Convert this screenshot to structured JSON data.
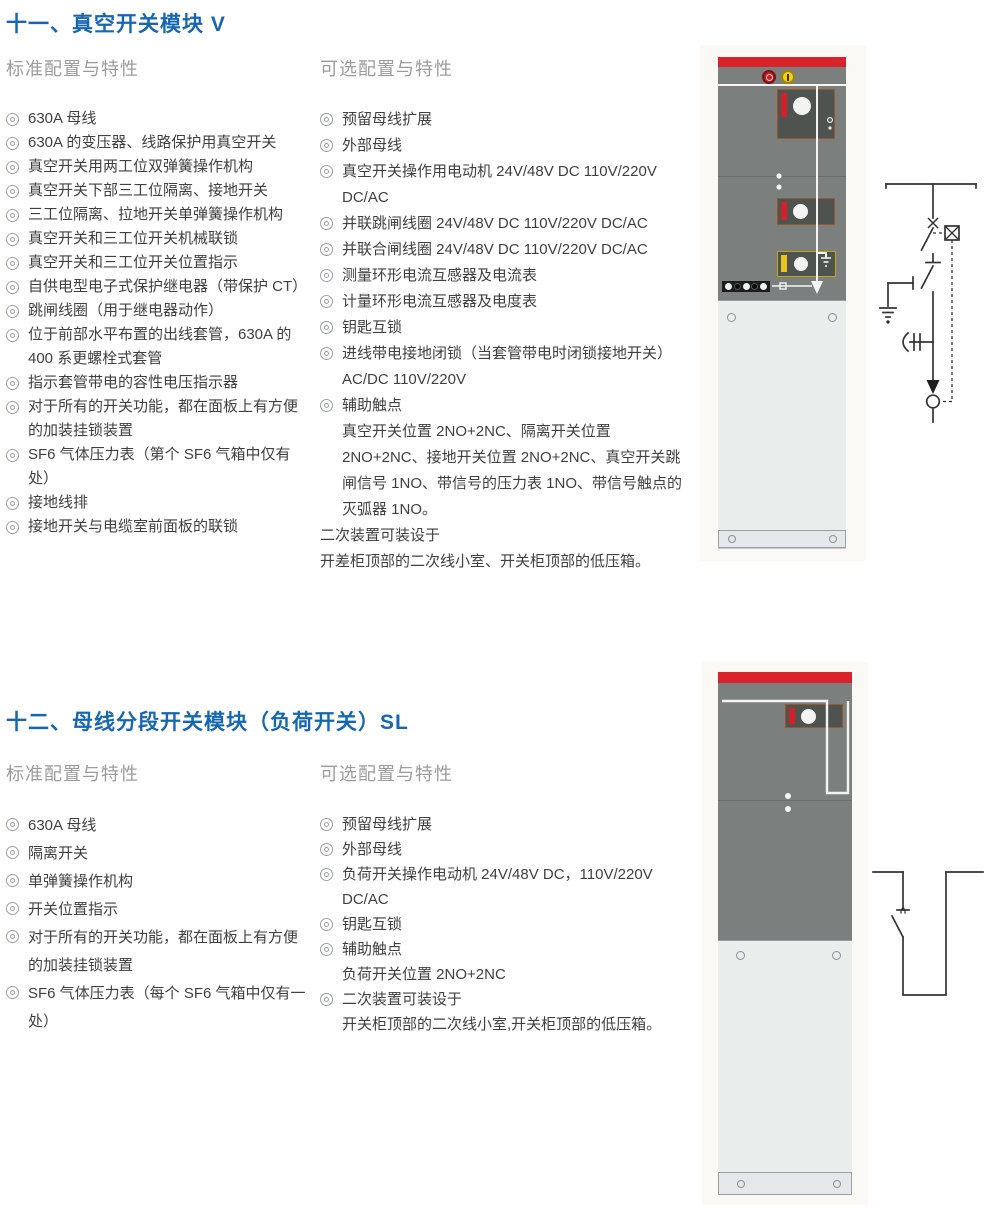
{
  "icons": {
    "bullet": "double-circle"
  },
  "colors": {
    "title_blue": "#1667b1",
    "heading_gray": "#9c9c9c",
    "body_text": "#404040",
    "cabinet_red": "#d8232a",
    "cabinet_gray": "#7b807e",
    "panel_dark": "#4e5350",
    "panel_border_brown": "#96572c",
    "accent_yellow": "#e8c41c",
    "lower_panel": "#e9edec",
    "diagram_line": "#333333"
  },
  "sections": [
    {
      "title": "十一、真空开关模块 V",
      "standard": {
        "heading": "标准配置与特性",
        "items": [
          "630A 母线",
          "630A 的变压器、线路保护用真空开关",
          "真空开关用两工位双弹簧操作机构",
          "真空开关下部三工位隔离、接地开关",
          "三工位隔离、拉地开关单弹簧操作机构",
          "真空开关和三工位开关机械联锁",
          "真空开关和三工位开关位置指示",
          "自供电型电子式保护继电器（带保护 CT）",
          "跳闸线圈（用于继电器动作）",
          "位于前部水平布置的出线套管，630A 的 400 系更螺栓式套管",
          "指示套管带电的容性电压指示器",
          "对于所有的开关功能，都在面板上有方便的加装挂锁装置",
          "SF6 气体压力表（第个 SF6 气箱中仅有处）",
          "接地线排",
          "接地开关与电缆室前面板的联锁"
        ]
      },
      "optional": {
        "heading": "可选配置与特性",
        "items": [
          {
            "text": "预留母线扩展"
          },
          {
            "text": "外部母线"
          },
          {
            "text": "真空开关操作用电动机 24V/48V DC 110V/220V DC/AC"
          },
          {
            "text": "并联跳闸线圈 24V/48V DC 110V/220V DC/AC"
          },
          {
            "text": "并联合闸线圈 24V/48V DC 110V/220V DC/AC"
          },
          {
            "text": "测量环形电流互感器及电流表"
          },
          {
            "text": "计量环形电流互感器及电度表"
          },
          {
            "text": "钥匙互锁"
          },
          {
            "text": "进线带电接地闭锁（当套管带电时闭锁接地开关）AC/DC 110V/220V"
          },
          {
            "text": "辅助触点",
            "sub": "真空开关位置 2NO+2NC、隔离开关位置 2NO+2NC、接地开关位置 2NO+2NC、真空开关跳闸信号 1NO、带信号的压力表 1NO、带信号触点的灭弧器 1NO。"
          }
        ],
        "footer": [
          "二次装置可装设于",
          "开差柜顶部的二次线小室、开关柜顶部的低压箱。"
        ]
      }
    },
    {
      "title": "十二、母线分段开关模块（负荷开关）SL",
      "standard": {
        "heading": "标准配置与特性",
        "items": [
          "630A 母线",
          "隔离开关",
          "单弹簧操作机构",
          "开关位置指示",
          "对于所有的开关功能，都在面板上有方便的加装挂锁装置",
          "SF6 气体压力表（每个 SF6 气箱中仅有一处）"
        ]
      },
      "optional": {
        "heading": "可选配置与特性",
        "items": [
          {
            "text": "预留母线扩展"
          },
          {
            "text": "外部母线"
          },
          {
            "text": "负荷开关操作电动机 24V/48V DC，110V/220V DC/AC"
          },
          {
            "text": "钥匙互锁"
          },
          {
            "text": "辅助触点",
            "sub": "负荷开关位置 2NO+2NC"
          },
          {
            "text": "二次装置可装设于",
            "sub": "开关柜顶部的二次线小室,开关柜顶部的低压箱。"
          }
        ]
      }
    }
  ]
}
